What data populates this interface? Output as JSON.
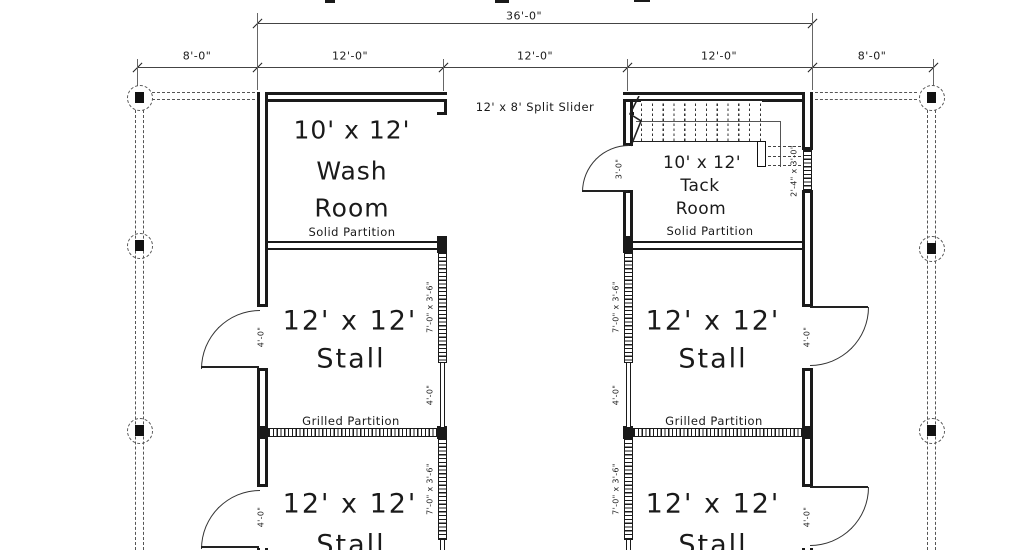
{
  "dimensions": {
    "overall_width": "36'-0\"",
    "segments": [
      "8'-0\"",
      "12'-0\"",
      "12'-0\"",
      "12'-0\"",
      "8'-0\""
    ]
  },
  "labels": {
    "split_slider": "12' x 8' Split Slider",
    "solid_partition": "Solid Partition",
    "grilled_partition": "Grilled Partition",
    "wash_size": "10' x 12'",
    "wash_name_line1": "Wash",
    "wash_name_line2": "Room",
    "tack_size": "10' x 12'",
    "tack_name_line1": "Tack",
    "tack_name_line2": "Room",
    "stall_size": "12' x 12'",
    "stall_name": "Stall",
    "grill_size": "7'-0\" x 3'-6\"",
    "four_foot": "4'-0\"",
    "three_foot": "3'-0\"",
    "stair_window": "2'-4\" x 3'-0\""
  },
  "colors": {
    "line": "#1a1a1a",
    "dashed": "#555555",
    "background": "#ffffff"
  }
}
